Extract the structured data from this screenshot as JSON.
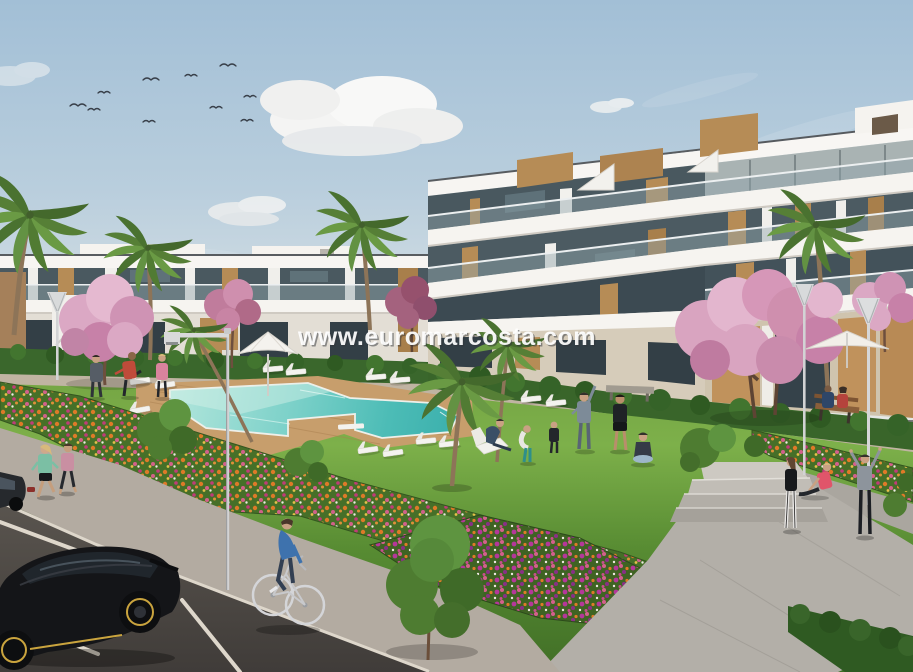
{
  "watermark": {
    "text": "www.euromarcosta.com"
  },
  "scene": {
    "description": "Sunny 3D architectural render of a modern white apartment complex with communal pool, landscaped gardens, flower beds, joggers, a cyclist and parked cars",
    "counts": {
      "birds": 10,
      "parked_cars": 2,
      "joggers": 2,
      "cyclists": 1,
      "sun_loungers": 14,
      "street_lamps": 4,
      "parasols": 2
    },
    "palette": {
      "sky_top": "#a2bfd6",
      "sky_horizon": "#e4e7e5",
      "building_white": "#f2f0ec",
      "building_wood": "#b68c56",
      "glass_dark": "#49585f",
      "glass_light": "#a9b3b3",
      "ground_floor_tan": "#c0925c",
      "lawn_light": "#7db04a",
      "lawn_dark": "#416f27",
      "pool_shallow": "#b3e6dc",
      "pool_deep": "#3aafac",
      "deck_wood": "#c79e6c",
      "blossom_pink": "#dba8c4",
      "flower_orange": "#e07a28",
      "flower_magenta": "#c23a7a",
      "flower_purple": "#8a2f86",
      "hedge_green": "#3a672c",
      "palm_green": "#567f36",
      "road_asphalt": "#4b4642",
      "sidewalk": "#b3aba1",
      "stone_path": "#b3afa8",
      "car_black": "#141518",
      "car_accent_yellow": "#c8a43e",
      "cyclist_shirt_blue": "#3e72ad"
    },
    "elements": [
      "sky",
      "clouds",
      "bird-flock",
      "apartment-building-right",
      "apartment-building-left",
      "rooftop-wood-boxes",
      "hedges",
      "back-path",
      "lawn",
      "swimming-pool",
      "pool-deck",
      "sun-loungers",
      "parasols",
      "flower-beds",
      "stone-path",
      "steps",
      "sidewalk",
      "road",
      "parking-lines",
      "parked-cars",
      "cyclist",
      "joggers",
      "pool-side-people",
      "exercise-group",
      "path-people",
      "bench-couple",
      "benches",
      "street-lamps",
      "palm-trees",
      "blossom-trees",
      "green-trees",
      "watermark"
    ]
  }
}
